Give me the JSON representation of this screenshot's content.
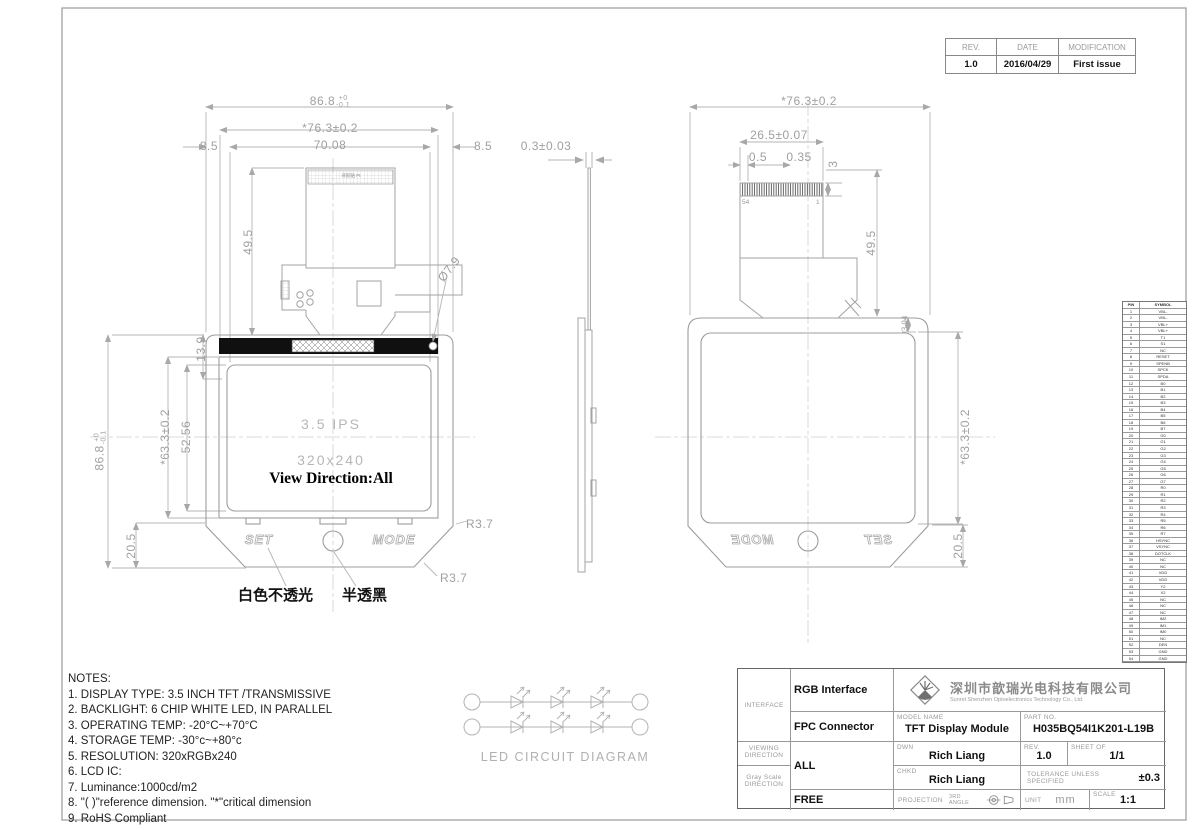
{
  "rev_table": {
    "headers": [
      "REV.",
      "DATE",
      "MODIFICATION"
    ],
    "row": [
      "1.0",
      "2016/04/29",
      "First issue"
    ]
  },
  "front_view": {
    "dims": {
      "overall_w": "86.8",
      "overall_w_tol_up": "+0",
      "overall_w_tol_dn": "-0.1",
      "bezel_w": "*76.3±0.2",
      "active_w": "70.08",
      "margin_left": "8.5",
      "margin_right": "8.5",
      "fpc_len": "49.5",
      "band_h": "13.9",
      "active_h": "52.56",
      "bezel_h": "*63.3±0.2",
      "overall_h": "86.8",
      "overall_h_tol_up": "+0",
      "overall_h_tol_dn": "-0.1",
      "bottom_h": "20.5",
      "hole_dia": "Ø7.9",
      "corner_r1": "R3.7",
      "corner_r2": "R3.7"
    },
    "display": {
      "line1": "3.5  IPS",
      "line2": "320x240",
      "line3": "View Direction:All"
    },
    "buttons": {
      "left": "SET",
      "right": "MODE"
    },
    "annotations": {
      "white_opaque": "白色不透光",
      "semi_black": "半透黑",
      "adhesive": "背胶贴 Pt"
    }
  },
  "side_view": {
    "dims": {
      "thickness": "0.3±0.03"
    }
  },
  "back_view": {
    "dims": {
      "overall_w": "*76.3±0.2",
      "conn_w": "26.5±0.07",
      "pin_margin": "0.5",
      "pin_pitch": "0.35",
      "conn_h": "3",
      "fpc_len": "49.5",
      "top_margin": "3.94",
      "bezel_h": "*63.3±0.2",
      "bottom_h": "20.5"
    },
    "pins": {
      "first": "54",
      "last": "1"
    },
    "buttons": {
      "left": "MODE",
      "right": "SET"
    }
  },
  "pin_table": {
    "headers": [
      "PIN",
      "SYMBOL"
    ],
    "rows": [
      [
        "1",
        "VBL-"
      ],
      [
        "2",
        "VBL-"
      ],
      [
        "3",
        "VBL+"
      ],
      [
        "4",
        "VBL+"
      ],
      [
        "5",
        "T1"
      ],
      [
        "6",
        "S1"
      ],
      [
        "7",
        "NC"
      ],
      [
        "8",
        "RESET"
      ],
      [
        "9",
        "SPENB"
      ],
      [
        "10",
        "SPCK"
      ],
      [
        "11",
        "SPDA"
      ],
      [
        "12",
        "B0"
      ],
      [
        "13",
        "B1"
      ],
      [
        "14",
        "B2"
      ],
      [
        "15",
        "B3"
      ],
      [
        "16",
        "B4"
      ],
      [
        "17",
        "B5"
      ],
      [
        "18",
        "B6"
      ],
      [
        "19",
        "B7"
      ],
      [
        "20",
        "G0"
      ],
      [
        "21",
        "G1"
      ],
      [
        "22",
        "G2"
      ],
      [
        "23",
        "G3"
      ],
      [
        "24",
        "G4"
      ],
      [
        "25",
        "G5"
      ],
      [
        "26",
        "G6"
      ],
      [
        "27",
        "G7"
      ],
      [
        "28",
        "R0"
      ],
      [
        "29",
        "R1"
      ],
      [
        "30",
        "R2"
      ],
      [
        "31",
        "R3"
      ],
      [
        "32",
        "R4"
      ],
      [
        "33",
        "R5"
      ],
      [
        "34",
        "R6"
      ],
      [
        "35",
        "R7"
      ],
      [
        "36",
        "HSYNC"
      ],
      [
        "37",
        "VSYNC"
      ],
      [
        "38",
        "DOTCLK"
      ],
      [
        "39",
        "NC"
      ],
      [
        "40",
        "NC"
      ],
      [
        "41",
        "VDD"
      ],
      [
        "42",
        "VDD"
      ],
      [
        "43",
        "Y2"
      ],
      [
        "44",
        "X2"
      ],
      [
        "45",
        "NC"
      ],
      [
        "46",
        "NC"
      ],
      [
        "47",
        "NC"
      ],
      [
        "48",
        "IM2"
      ],
      [
        "49",
        "IM1"
      ],
      [
        "50",
        "IM0"
      ],
      [
        "51",
        "NC"
      ],
      [
        "52",
        "DEN"
      ],
      [
        "53",
        "GND"
      ],
      [
        "54",
        "GND"
      ]
    ]
  },
  "notes": {
    "title": "NOTES:",
    "lines": [
      "1. DISPLAY TYPE: 3.5  INCH TFT /TRANSMISSIVE",
      "2. BACKLIGHT: 6 CHIP WHITE LED, IN PARALLEL",
      "3. OPERATING TEMP: -20°C~+70°C",
      "4. STORAGE TEMP: -30°c~+80°c",
      "5. RESOLUTION: 320xRGBx240",
      "6. LCD IC:",
      "7.  Luminance:1000cd/m2",
      "8. \"( )\"reference dimension. \"*\"critical dimension",
      "9. RoHS Compliant"
    ]
  },
  "led_diagram": {
    "label": "LED CIRCUIT DIAGRAM"
  },
  "title_block": {
    "interface_label": "INTERFACE",
    "interface_1": "RGB Interface",
    "interface_2": "FPC Connector",
    "viewing_label_1": "VIEWING",
    "viewing_label_2": "DIRECTION",
    "viewing_value": "ALL",
    "gray_label_1": "Gray Scale",
    "gray_label_2": "DIRECTION",
    "gray_value": "FREE",
    "company_cn": "深圳市歆瑞光电科技有限公司",
    "company_en": "Sunrel Shenzhen Optoelectronics Technology Co., Ltd.",
    "model_label": "MODEL NAME",
    "model_value": "TFT Display Module",
    "part_label": "PART NO.",
    "part_value": "H035BQ54I1K201-L19B",
    "dwn_label": "DWN",
    "dwn_value": "Rich Liang",
    "rev_label": "REV.",
    "rev_value": "1.0",
    "sheet_label": "SHEET OF",
    "sheet_value": "1/1",
    "chkd_label": "CHKD",
    "chkd_value": "Rich Liang",
    "tol_label_1": "TOLERANCE UNLESS",
    "tol_label_2": "SPECIFIED",
    "tol_value": "±0.3",
    "proj_label": "PROJECTION",
    "proj_value": "3RD ANGLE",
    "unit_label": "UNIT",
    "unit_value": "mm",
    "scale_label": "SCALE",
    "scale_value": "1:1"
  }
}
